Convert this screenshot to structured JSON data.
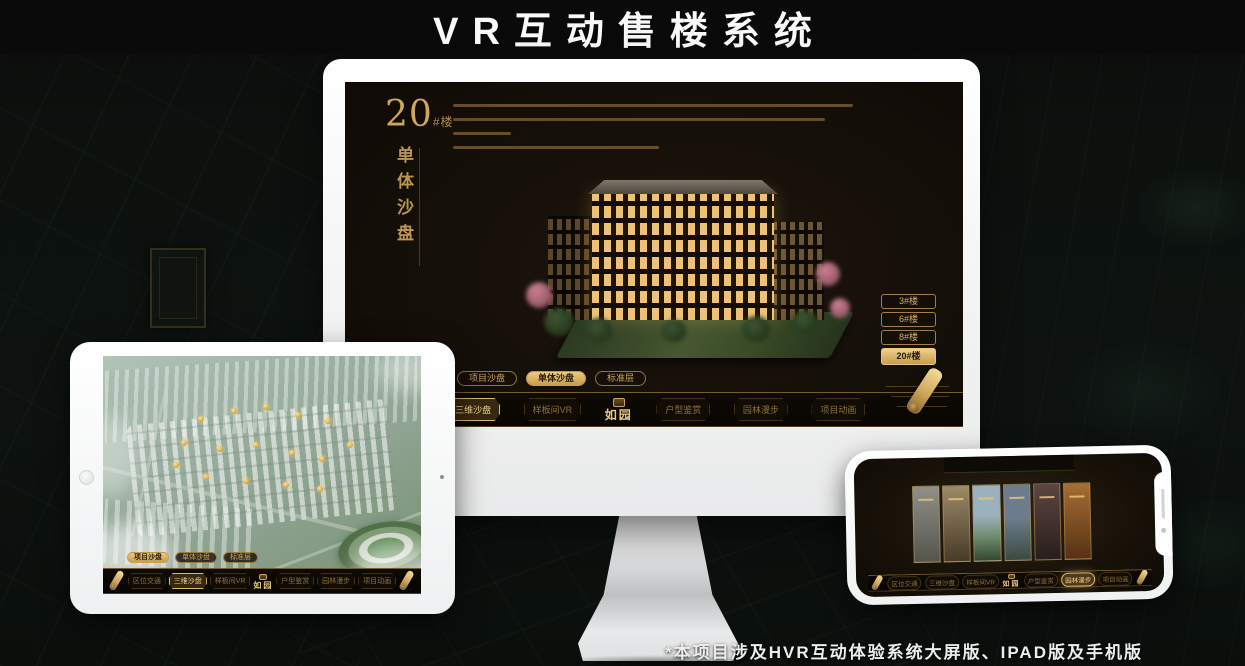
{
  "page": {
    "title": "VR互动售楼系统",
    "footnote": "*本项目涉及HVR互动体验系统大屏版、IPAD版及手机版"
  },
  "colors": {
    "gold": "#c9a159",
    "gold_bright": "#f2d791",
    "screen_bg": "#16100a",
    "frame_white": "#ffffff"
  },
  "shared": {
    "tabs": [
      "项目沙盘",
      "单体沙盘",
      "标准层"
    ],
    "nav_items": [
      "区位交通",
      "三维沙盘",
      "样板间VR",
      "户型鉴赏",
      "园林漫步",
      "项目动画"
    ],
    "logo": "如园"
  },
  "monitor": {
    "floor_number": "20",
    "floor_unit": "#楼",
    "subtitle": "单体沙盘",
    "active_tab": "单体沙盘",
    "active_nav": "三维沙盘",
    "floor_buttons": [
      {
        "label": "3#楼",
        "active": false
      },
      {
        "label": "6#楼",
        "active": false
      },
      {
        "label": "8#楼",
        "active": false
      },
      {
        "label": "20#楼",
        "active": true
      }
    ]
  },
  "tablet": {
    "active_tab": "项目沙盘",
    "active_nav": "三维沙盘"
  },
  "phone": {
    "active_nav": "园林漫步"
  }
}
